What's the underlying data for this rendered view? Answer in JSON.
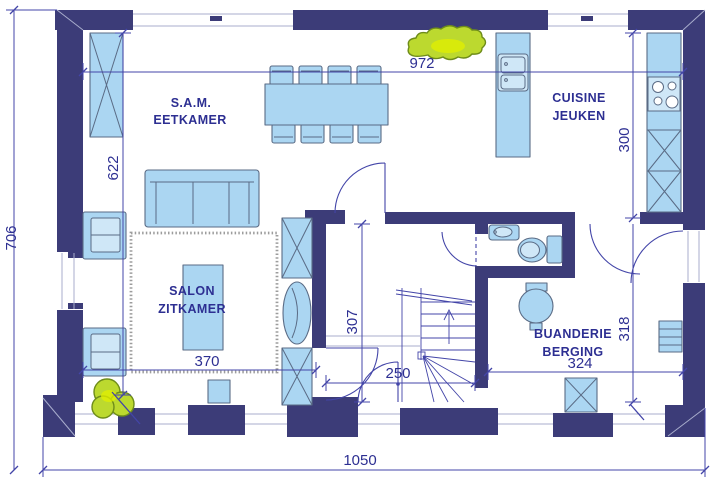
{
  "colors": {
    "paper": "#ffffff",
    "wall": "#3c3c78",
    "dim_line": "#4345a8",
    "label_text": "#2d2f92",
    "furniture_fill": "#abd6f2",
    "furniture_light": "#cfe7f7",
    "furniture_stroke": "#5a6b85",
    "window_line": "#a8adcc",
    "rug_stroke": "#8d8d8d",
    "plant_fill": "#bcd92f",
    "plant_glow": "#e2ef00",
    "plant_stroke": "#6e8c1a"
  },
  "rooms": {
    "dining": {
      "line1": "S.A.M.",
      "line2": "EETKAMER"
    },
    "kitchen": {
      "line1": "CUISINE",
      "line2": "JEUKEN"
    },
    "living": {
      "line1": "SALON",
      "line2": "ZITKAMER"
    },
    "laundry": {
      "line1": "BUANDERIE",
      "line2": "BERGING"
    }
  },
  "dimensions": {
    "interior_width_top": "972",
    "dining_depth": "622",
    "total_depth": "706",
    "kitchen_depth": "300",
    "hall_depth": "307",
    "entry_depth": "318",
    "living_width": "370",
    "hall_width": "250",
    "laundry_width": "324",
    "total_width": "1050"
  }
}
